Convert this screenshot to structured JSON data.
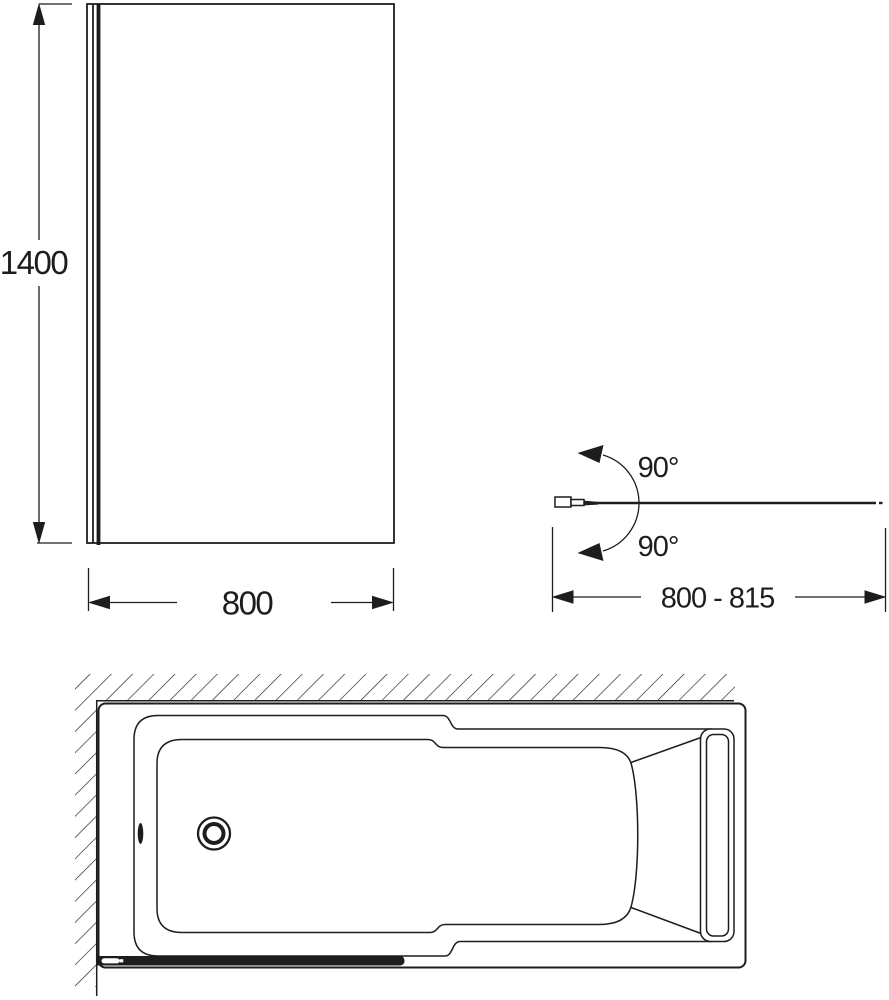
{
  "colors": {
    "ink": "#1d1d1b",
    "background": "#ffffff"
  },
  "front_view": {
    "height_label": "1400",
    "width_label": "800"
  },
  "top_view": {
    "swing_upper_label": "90°",
    "swing_lower_label": "90°",
    "width_range_label": "800 - 815"
  }
}
